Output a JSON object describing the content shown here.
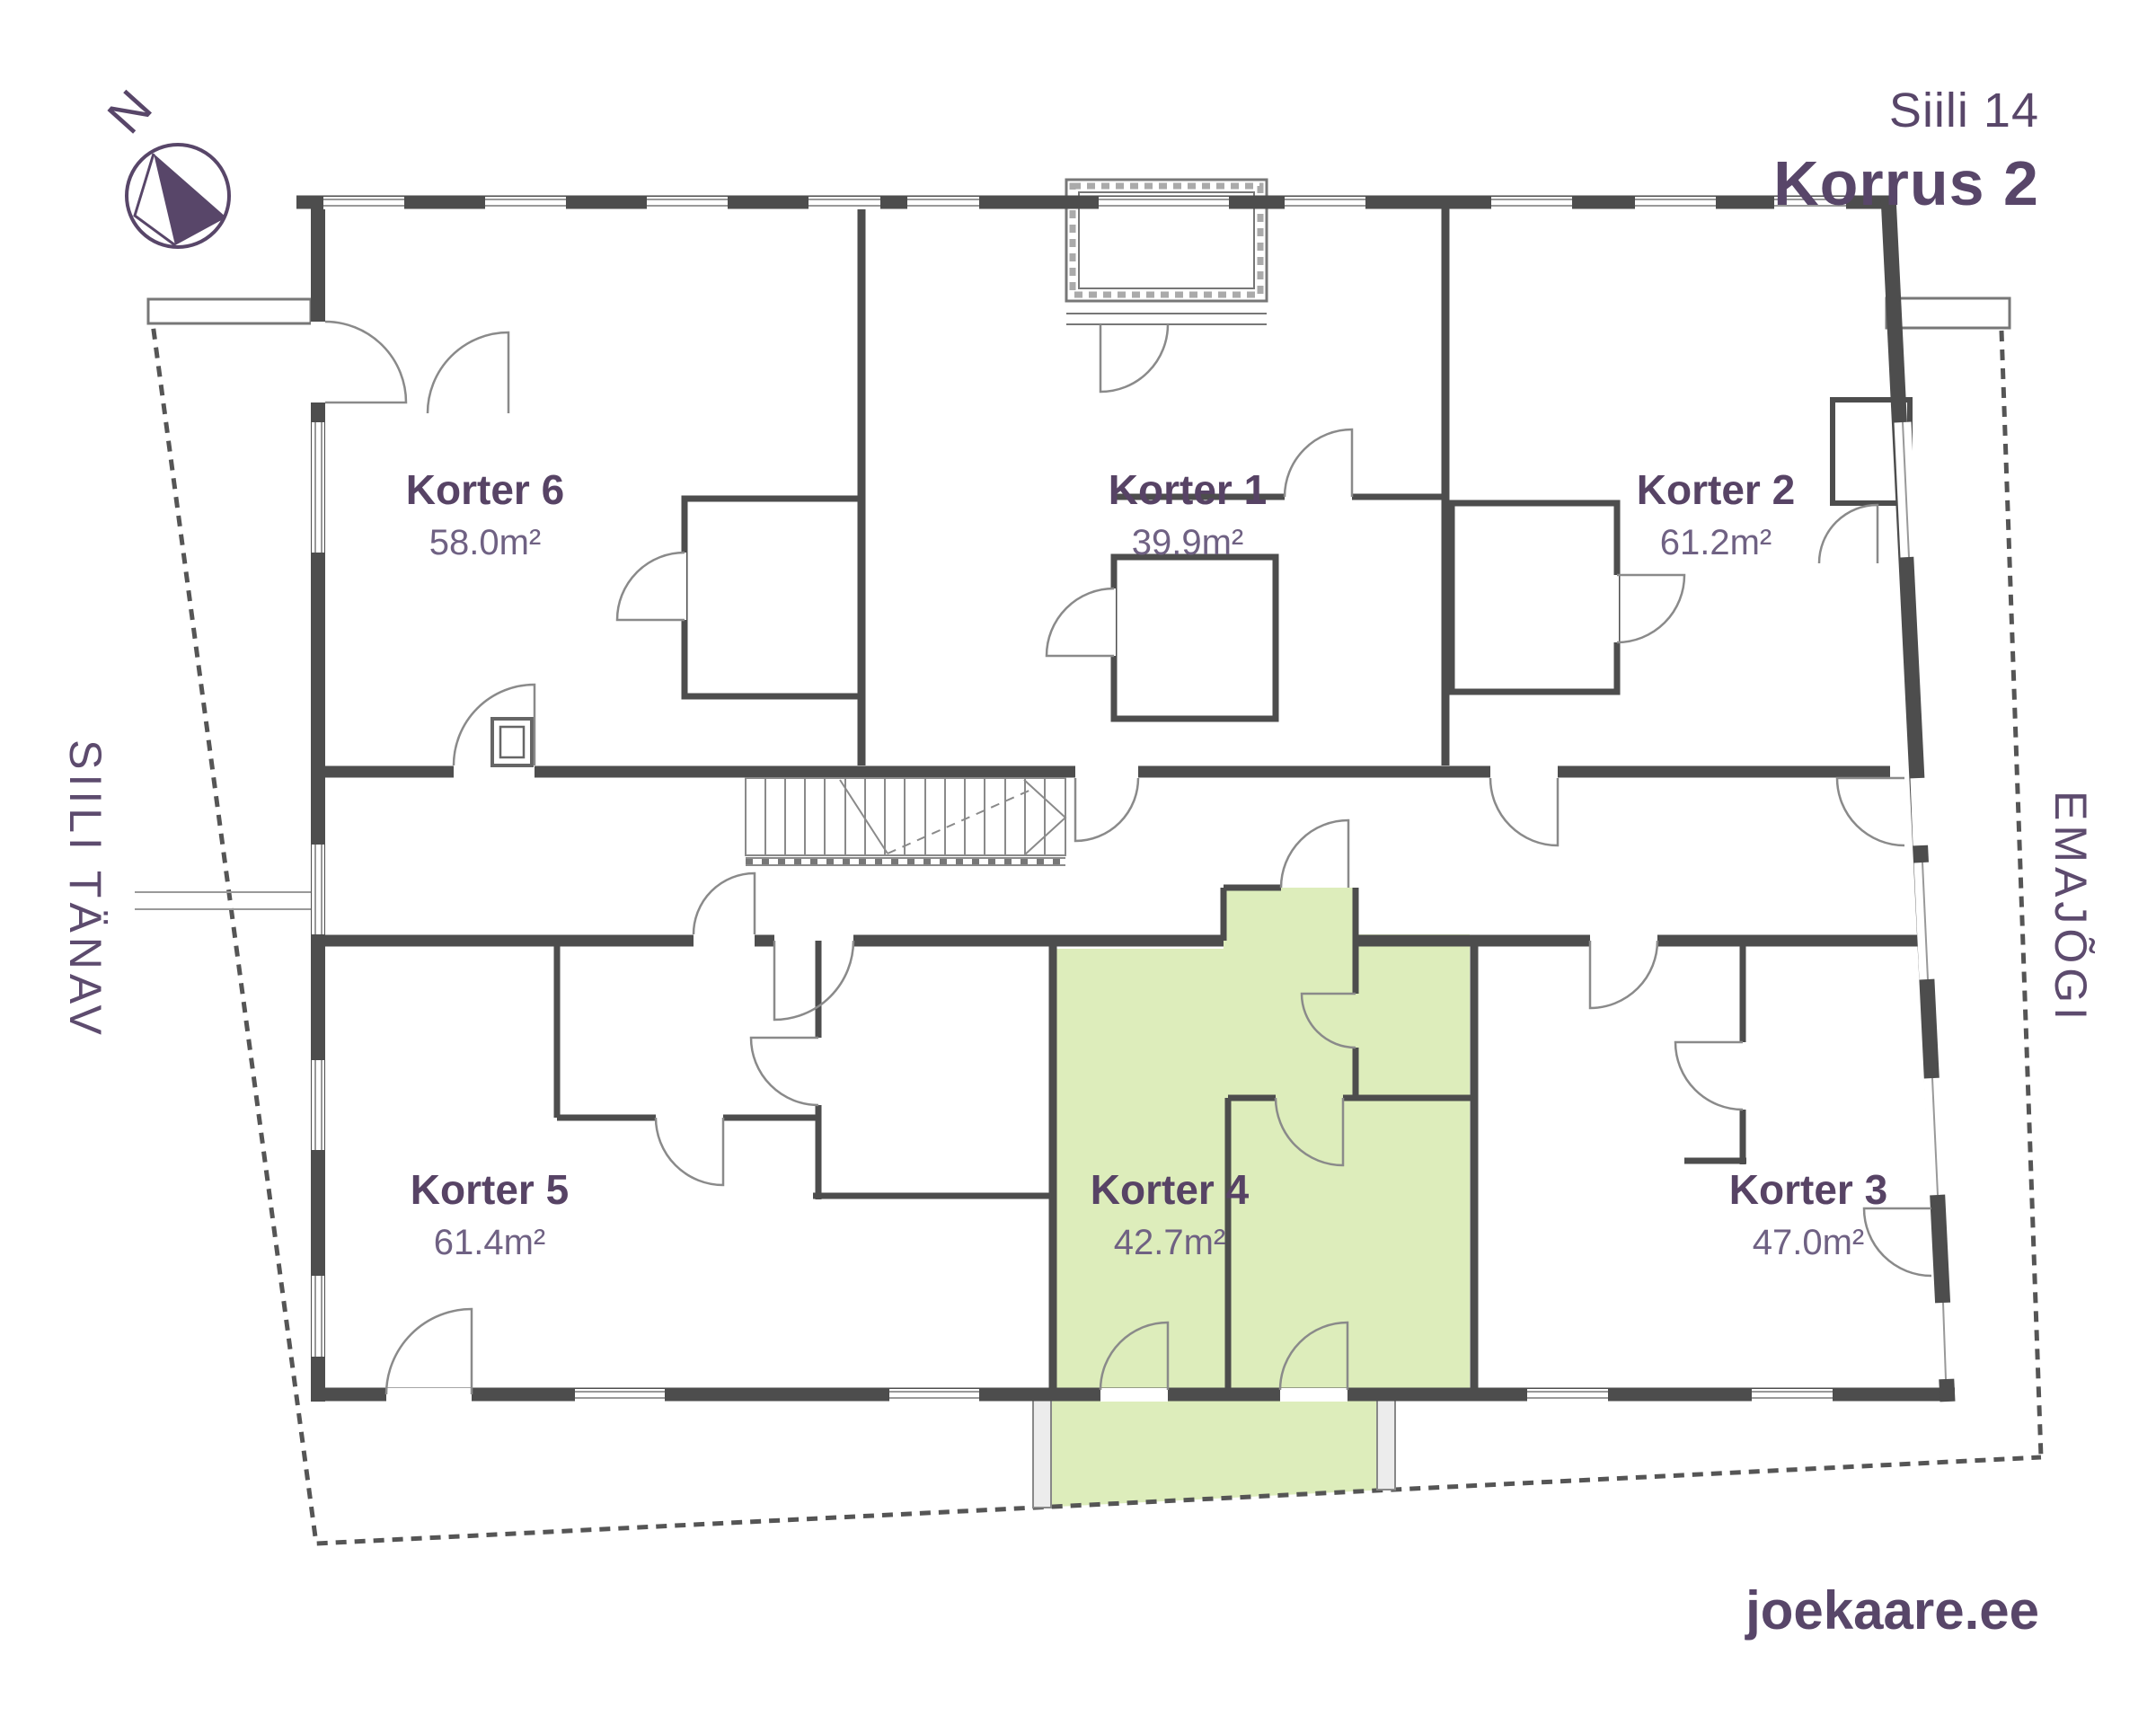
{
  "header": {
    "project": "Siili 14",
    "floor": "Korrus 2"
  },
  "compass": {
    "label": "N"
  },
  "streets": {
    "left": "SIILI TÄNAV",
    "right": "EMAJÕGI"
  },
  "footer": {
    "website": "joekaare.ee"
  },
  "plan": {
    "building": "Siili 14",
    "apartments": [
      {
        "id": "korter-1",
        "name": "Korter 1",
        "area": "39.9m²",
        "highlighted": false
      },
      {
        "id": "korter-2",
        "name": "Korter 2",
        "area": "61.2m²",
        "highlighted": false
      },
      {
        "id": "korter-3",
        "name": "Korter 3",
        "area": "47.0m²",
        "highlighted": false
      },
      {
        "id": "korter-4",
        "name": "Korter 4",
        "area": "42.7m²",
        "highlighted": true
      },
      {
        "id": "korter-5",
        "name": "Korter 5",
        "area": "61.4m²",
        "highlighted": false
      },
      {
        "id": "korter-6",
        "name": "Korter 6",
        "area": "58.0m²",
        "highlighted": false
      }
    ],
    "colors": {
      "highlight": "#ddedbb",
      "wall": "#4d4d4d",
      "accent": "#574365",
      "area_text": "#6f6183"
    }
  }
}
